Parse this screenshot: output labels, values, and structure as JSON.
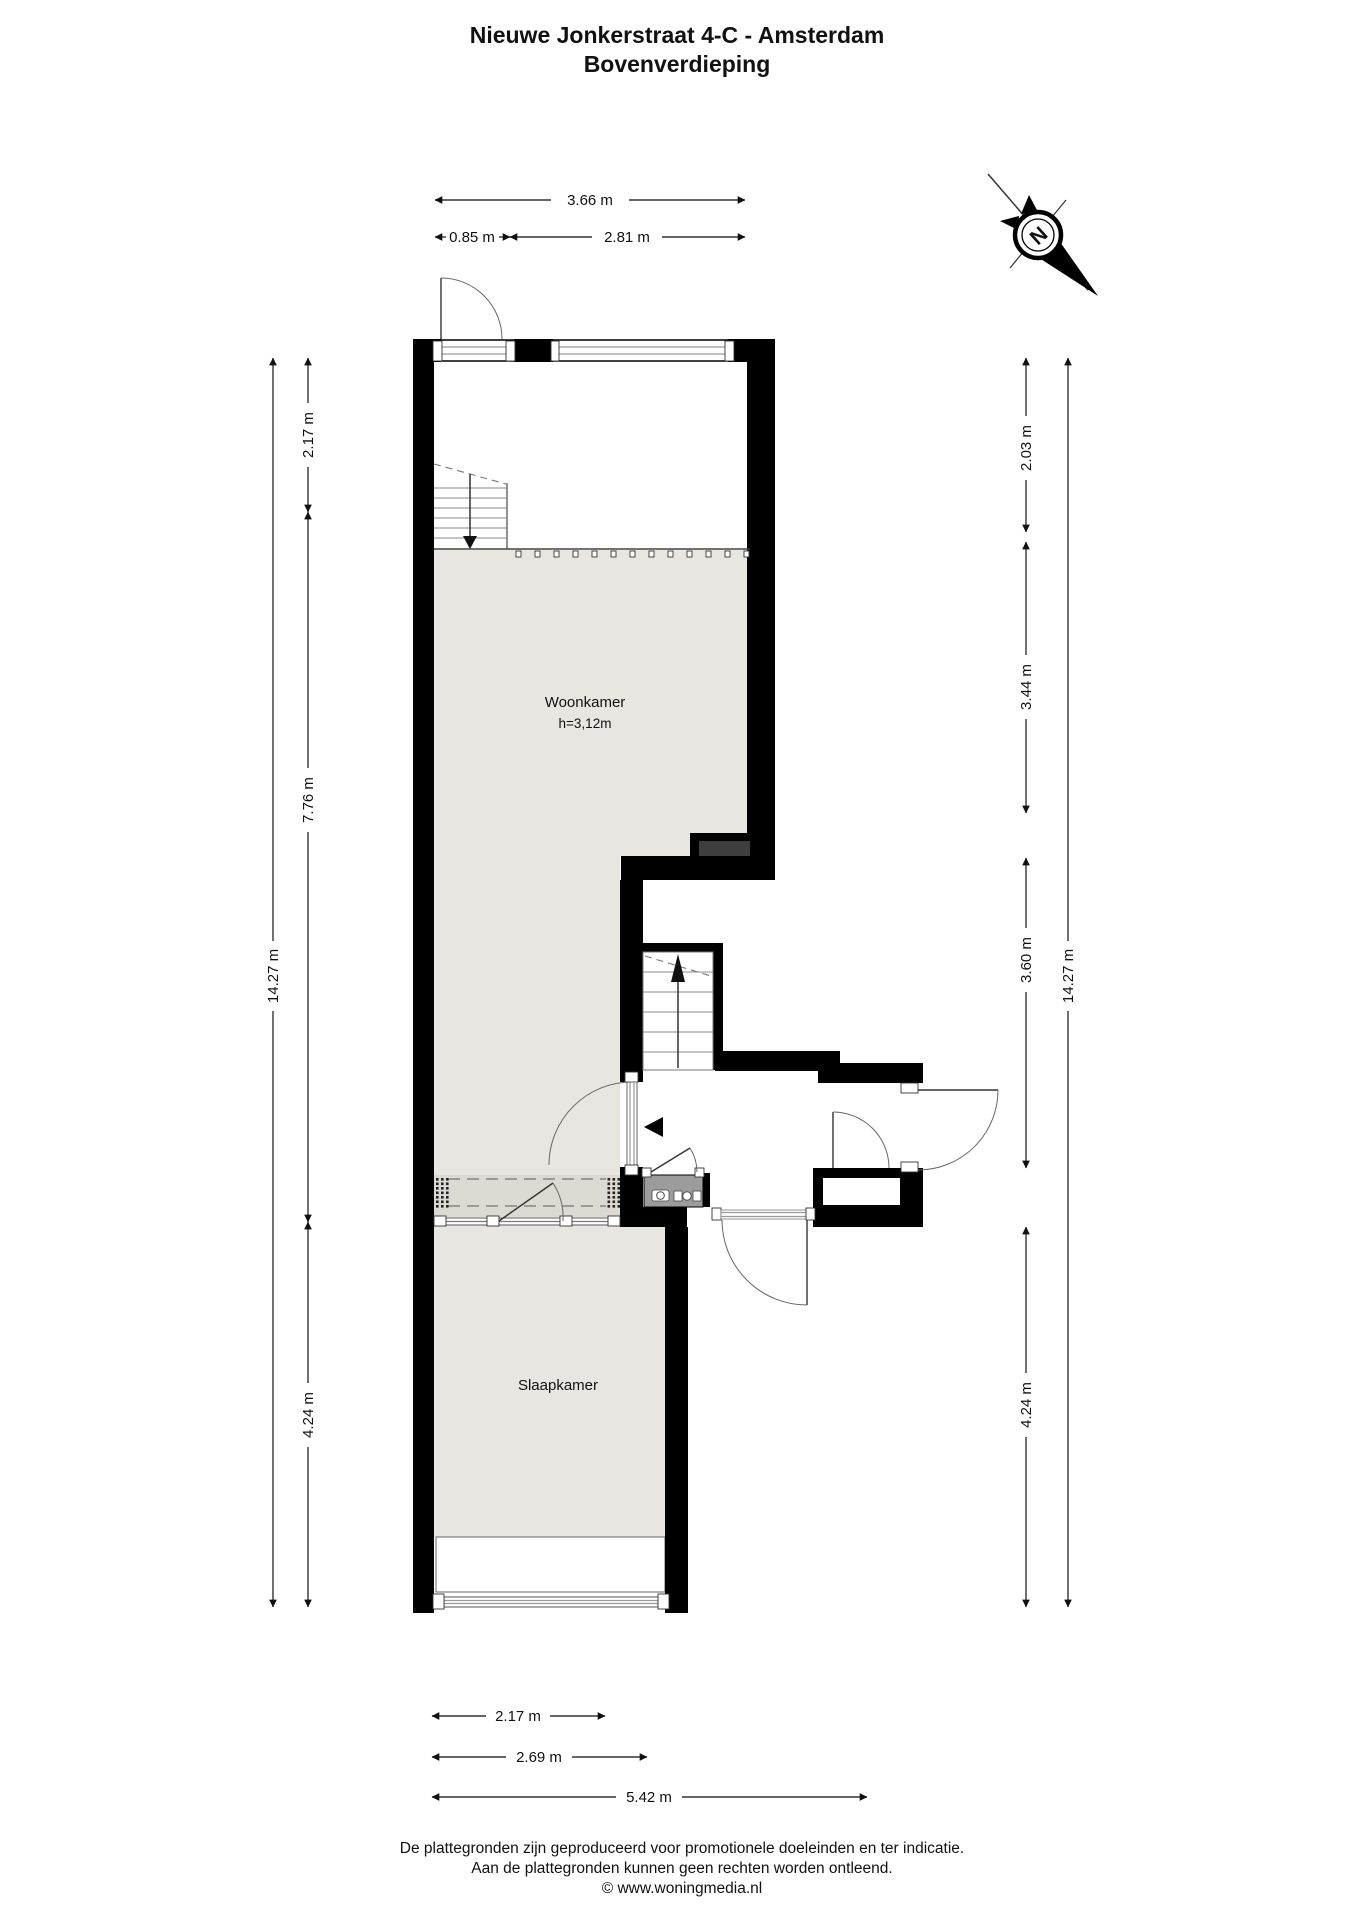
{
  "header": {
    "title_line1": "Nieuwe Jonkerstraat 4-C - Amsterdam",
    "title_line2": "Bovenverdieping"
  },
  "compass": {
    "north_label": "N"
  },
  "rooms": {
    "woonkamer": {
      "name": "Woonkamer",
      "ceiling_height": "h=3,12m"
    },
    "slaapkamer": {
      "name": "Slaapkamer"
    }
  },
  "dimensions": {
    "top": {
      "total": "3.66 m",
      "left": "0.85 m",
      "right": "2.81 m"
    },
    "left": {
      "outer": "14.27 m",
      "seg1": "2.17 m",
      "seg2": "7.76 m",
      "seg3": "4.24 m"
    },
    "right": {
      "outer": "14.27 m",
      "seg1": "2.03 m",
      "seg2": "3.44 m",
      "seg3": "3.60 m",
      "seg4": "4.24 m"
    },
    "bottom": {
      "seg1": "2.17 m",
      "seg2": "2.69 m",
      "seg3": "5.42 m"
    }
  },
  "footer": {
    "line1": "De plattegronden zijn geproduceerd voor promotionele doeleinden en ter indicatie.",
    "line2": "Aan de plattegronden kunnen geen rechten worden ontleend.",
    "line3": "© www.woningmedia.nl"
  },
  "colors": {
    "wall": "#000000",
    "floor": "#e8e6e0",
    "band": "#dcdad2",
    "kitchen": "#9c9c9c",
    "chimney": "#3e3e3e",
    "line": "#333333"
  }
}
